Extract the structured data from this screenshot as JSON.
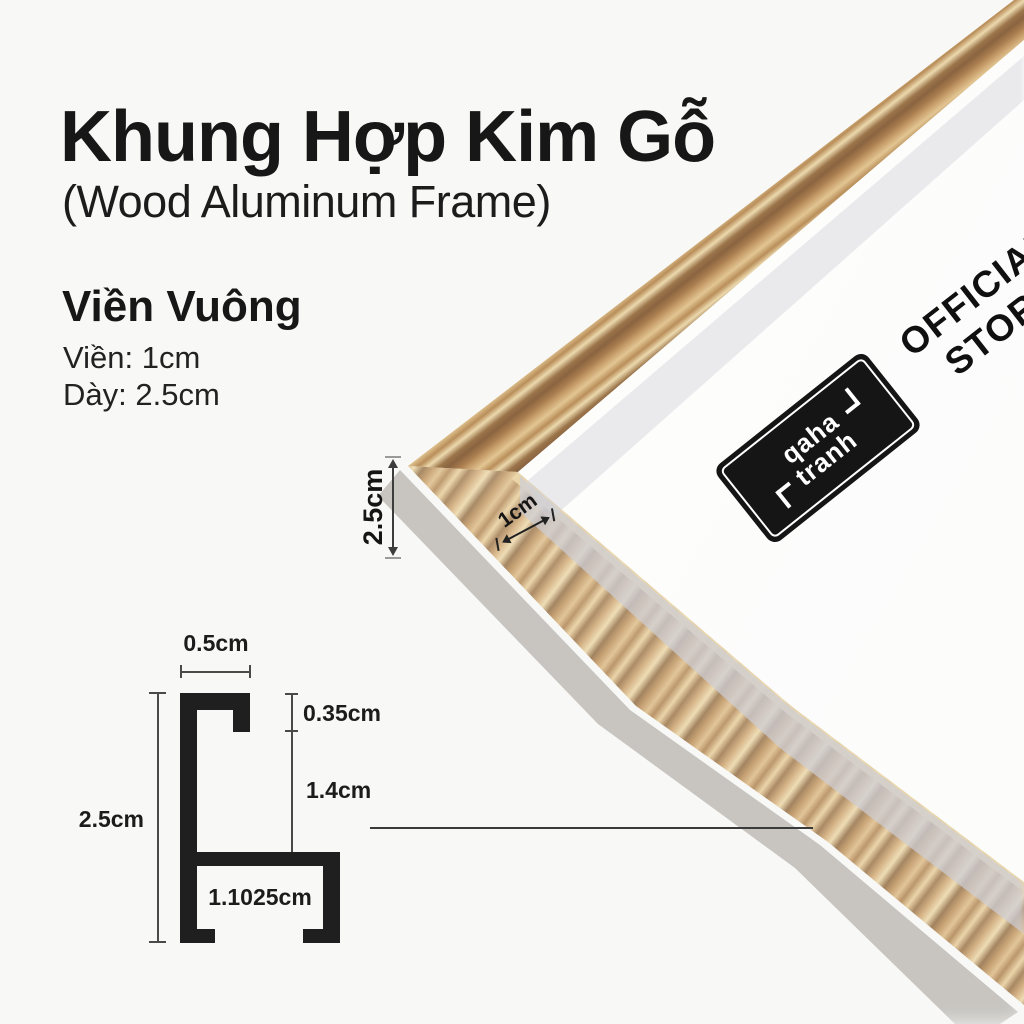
{
  "header": {
    "title": "Khung Hợp Kim Gỗ",
    "subtitle": "(Wood Aluminum Frame)"
  },
  "specs": {
    "heading": "Viền Vuông",
    "border": "Viền: 1cm",
    "thickness": "Dày: 2.5cm"
  },
  "photo": {
    "thickness_label": "2.5cm",
    "border_label": "1cm",
    "brand": {
      "line1": "qaha",
      "line2": "tranh"
    },
    "badge": {
      "line1": "OFFICIAL",
      "line2": "STORE"
    }
  },
  "profile_diagram": {
    "top_width": "0.5cm",
    "lip_depth": "0.35cm",
    "channel_height": "1.4cm",
    "total_height": "2.5cm",
    "inner_width": "1.1025cm"
  },
  "colors": {
    "background": "#f8f8f6",
    "text": "#171717",
    "wood_light": "#e9d6ac",
    "wood_mid": "#c49a66",
    "wood_dark": "#8a6540",
    "badge_black": "#151515",
    "mat_white": "#fcfcfb",
    "glass_gray": "#d6d6dc"
  }
}
